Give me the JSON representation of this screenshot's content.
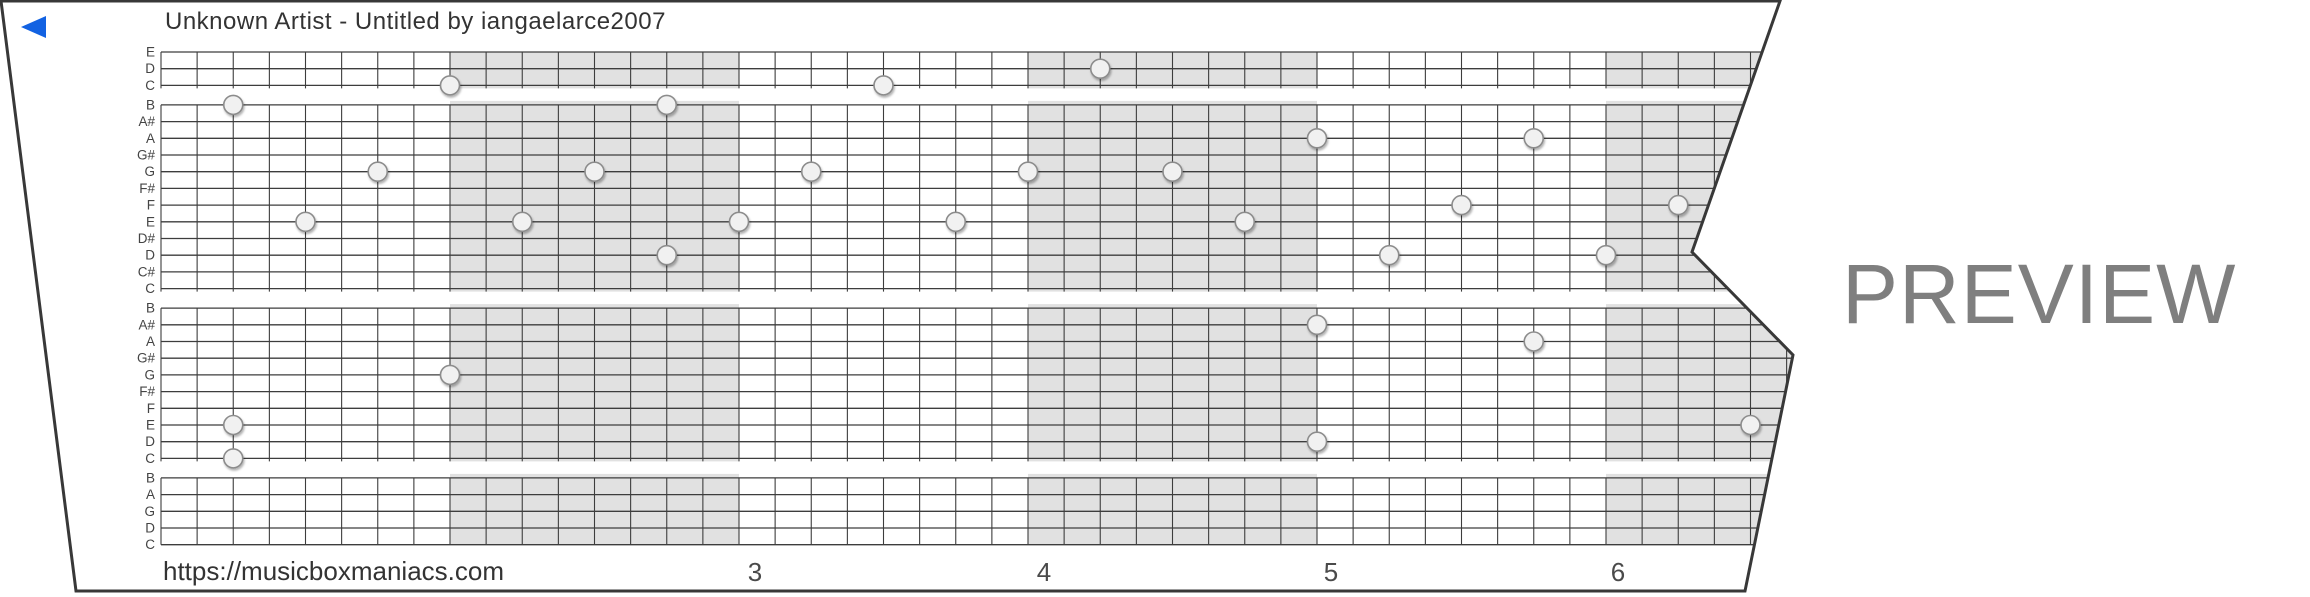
{
  "header": {
    "title": "Unknown Artist - Untitled by iangaelarce2007"
  },
  "footer": {
    "url": "https://musicboxmaniacs.com"
  },
  "watermark": {
    "label": "PREVIEW"
  },
  "icons": {
    "start_marker": "left-pointing-triangle"
  },
  "grid": {
    "row_labels": [
      "E",
      "D",
      "C",
      "B",
      "A#",
      "A",
      "G#",
      "G",
      "F#",
      "F",
      "E",
      "D#",
      "D",
      "C#",
      "C",
      "B",
      "A#",
      "A",
      "G#",
      "G",
      "F#",
      "F",
      "E",
      "D",
      "C",
      "B",
      "A",
      "G",
      "D",
      "C"
    ],
    "octave_gap_after_rows": [
      2,
      14,
      24
    ],
    "measure_numbers": [
      {
        "label": "3",
        "cx": 755
      },
      {
        "label": "4",
        "cx": 1044
      },
      {
        "label": "5",
        "cx": 1331
      },
      {
        "label": "6",
        "cx": 1618
      }
    ],
    "shaded_measures": [
      1,
      3,
      5
    ],
    "notes": [
      {
        "pitch": "D",
        "row": 1,
        "beat": 26
      },
      {
        "pitch": "C",
        "row": 2,
        "beat": 8
      },
      {
        "pitch": "C",
        "row": 2,
        "beat": 20
      },
      {
        "pitch": "B",
        "row": 3,
        "beat": 2
      },
      {
        "pitch": "B",
        "row": 3,
        "beat": 14
      },
      {
        "pitch": "A",
        "row": 5,
        "beat": 32
      },
      {
        "pitch": "A",
        "row": 5,
        "beat": 38
      },
      {
        "pitch": "G",
        "row": 7,
        "beat": 6
      },
      {
        "pitch": "G",
        "row": 7,
        "beat": 12
      },
      {
        "pitch": "G",
        "row": 7,
        "beat": 18
      },
      {
        "pitch": "G",
        "row": 7,
        "beat": 24
      },
      {
        "pitch": "G",
        "row": 7,
        "beat": 28
      },
      {
        "pitch": "F",
        "row": 9,
        "beat": 36
      },
      {
        "pitch": "F",
        "row": 9,
        "beat": 42
      },
      {
        "pitch": "E",
        "row": 10,
        "beat": 4
      },
      {
        "pitch": "E",
        "row": 10,
        "beat": 10
      },
      {
        "pitch": "E",
        "row": 10,
        "beat": 16
      },
      {
        "pitch": "E",
        "row": 10,
        "beat": 22
      },
      {
        "pitch": "E",
        "row": 10,
        "beat": 30
      },
      {
        "pitch": "D",
        "row": 12,
        "beat": 14
      },
      {
        "pitch": "D",
        "row": 12,
        "beat": 34
      },
      {
        "pitch": "D",
        "row": 12,
        "beat": 40
      },
      {
        "pitch": "A#",
        "row": 16,
        "beat": 32
      },
      {
        "pitch": "A",
        "row": 17,
        "beat": 38
      },
      {
        "pitch": "G",
        "row": 19,
        "beat": 8
      },
      {
        "pitch": "E",
        "row": 22,
        "beat": 2
      },
      {
        "pitch": "E",
        "row": 22,
        "beat": 44
      },
      {
        "pitch": "D",
        "row": 23,
        "beat": 32
      },
      {
        "pitch": "C",
        "row": 24,
        "beat": 2
      }
    ]
  },
  "colors": {
    "grid_line": "#3d3d3d",
    "measure_shade": "#e1e1e1",
    "note_fill": "#f1f1f1",
    "note_stroke": "#8c8c8c",
    "strip_border": "#383838",
    "row_label_text": "#444444",
    "measure_number_text": "#4a4a4a",
    "title_text": "#333333",
    "preview_text": "#7f7f7f",
    "start_marker_blue": "#1262e2"
  }
}
